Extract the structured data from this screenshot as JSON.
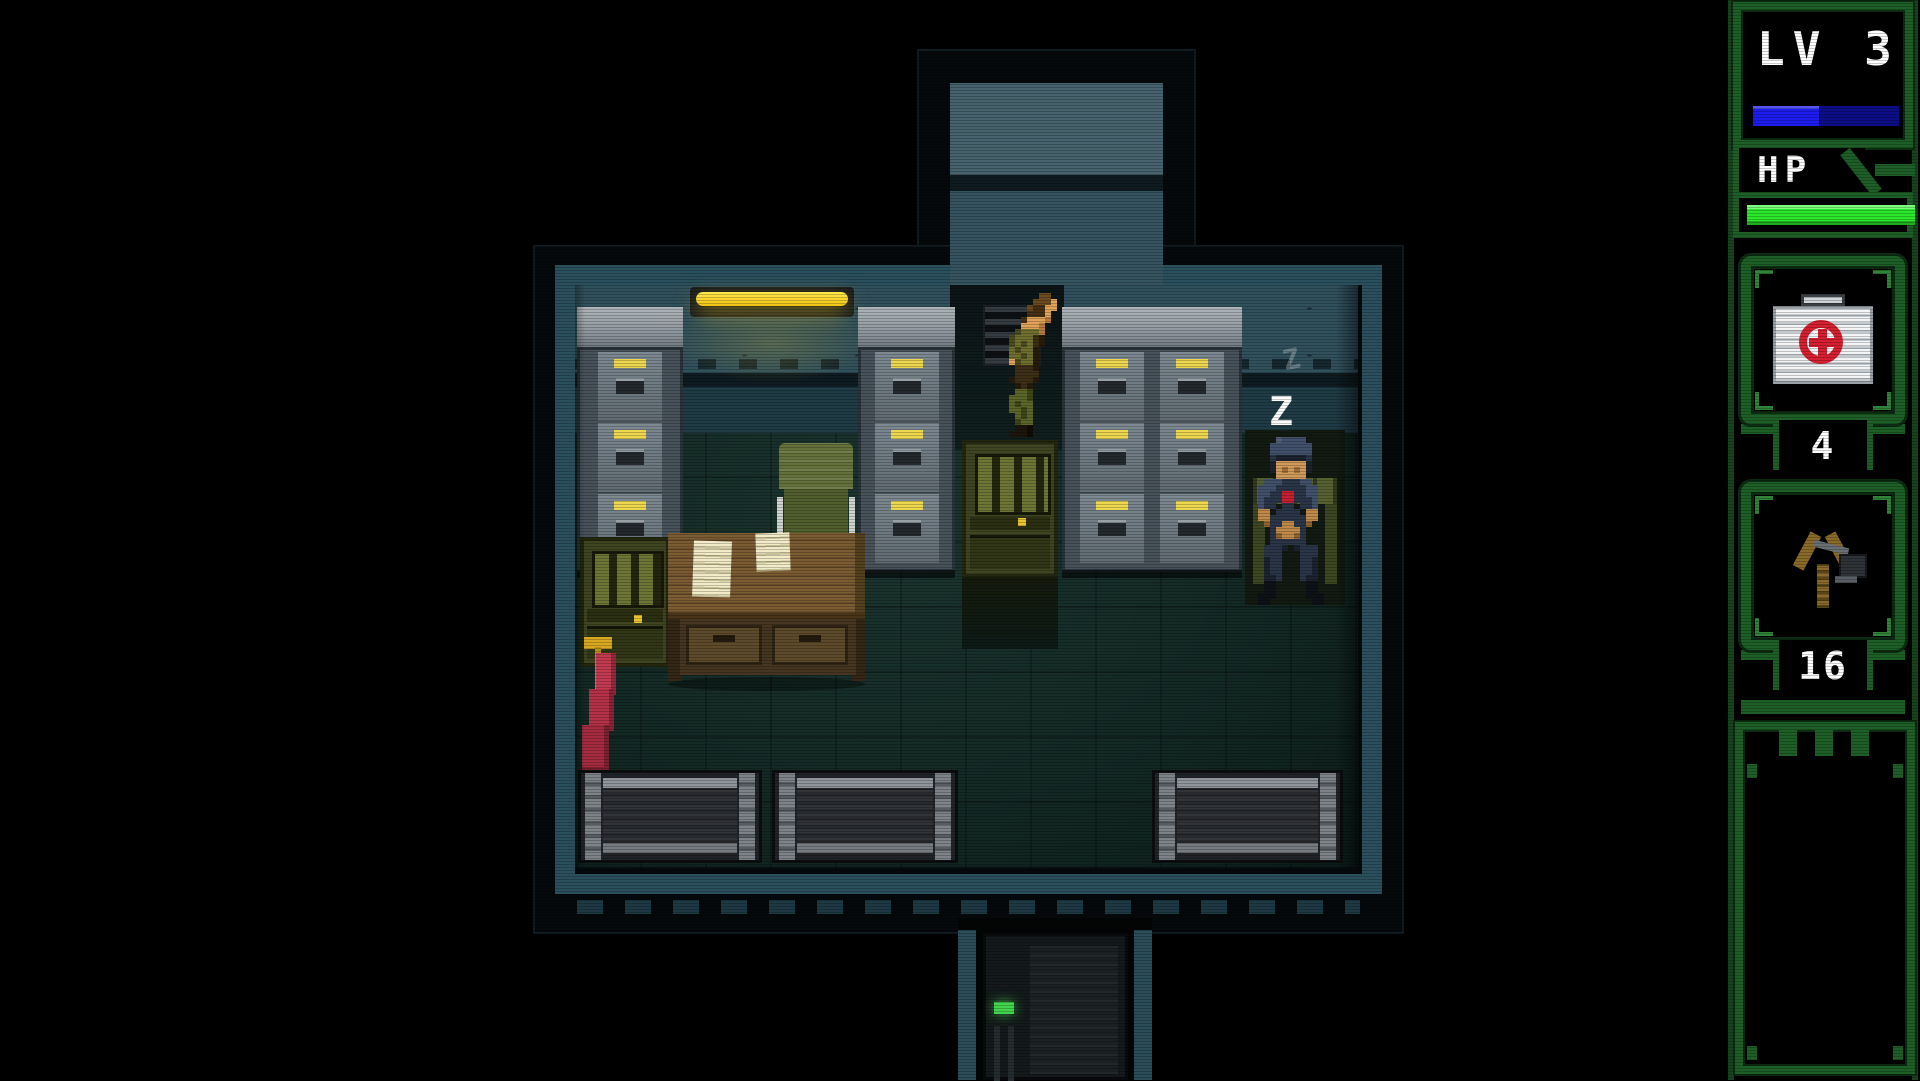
{
  "hud": {
    "level": {
      "label": "LV 3",
      "xp_percent": 45,
      "xp_color": "#1c1cee",
      "xp_back_color": "#0d0d86"
    },
    "hp": {
      "label": "HP",
      "percent": 100,
      "bar_color": "#2ce82c"
    },
    "items": [
      {
        "id": "medkit",
        "icon": "medkit-icon",
        "count": "4"
      },
      {
        "id": "slingshot",
        "icon": "slingshot-icon",
        "count": "16"
      }
    ],
    "message_panel_text": "",
    "frame_color": "#1d5f27"
  },
  "game": {
    "sleep_indicator": "Z",
    "sleep_indicator_faint": "Z",
    "entities": [
      "player-character",
      "sleeping-guard",
      "filing-cabinet",
      "filing-cabinet",
      "filing-cabinet-double",
      "office-chair",
      "desk",
      "papers",
      "red-flag",
      "ceiling-light",
      "wall-vent",
      "radio-machine",
      "radio-machine",
      "storage-crate",
      "storage-crate",
      "storage-crate",
      "door-with-led",
      "corridor-north",
      "corridor-south"
    ],
    "door_led_color": "#42d44c"
  }
}
